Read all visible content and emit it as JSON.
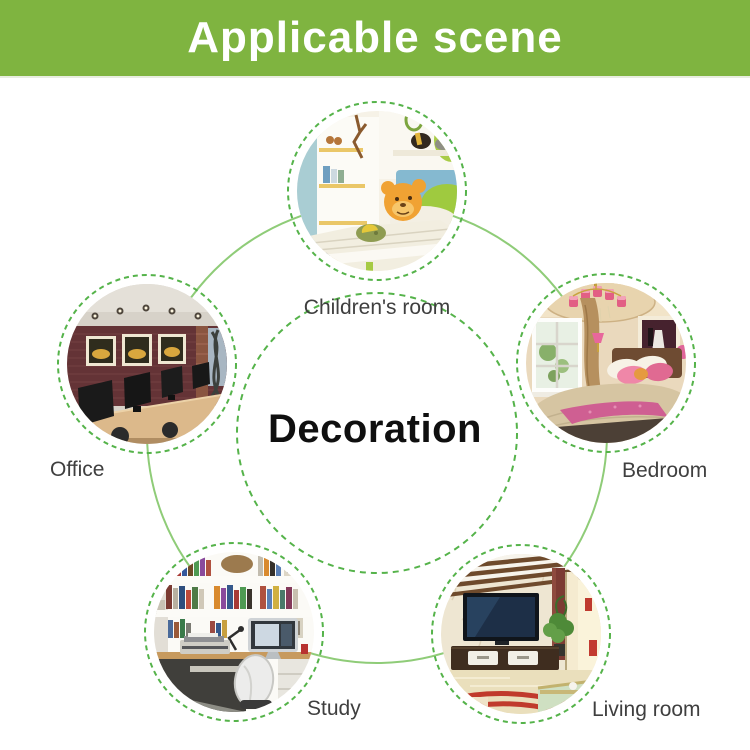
{
  "header": {
    "title": "Applicable scene",
    "bg_color": "#7fb440",
    "text_color": "#ffffff"
  },
  "center": {
    "title": "Decoration"
  },
  "nodes": [
    {
      "id": "children-room",
      "label": "Children's room",
      "scene": "kids bedroom with shelves, bed and orange teddy bear"
    },
    {
      "id": "office",
      "label": "Office",
      "scene": "dark office with brick wall, framed pictures, desk monitors"
    },
    {
      "id": "bedroom",
      "label": "Bedroom",
      "scene": "warm bedroom with chandelier, window, pink bedding"
    },
    {
      "id": "study",
      "label": "Study",
      "scene": "home study with bookshelves, monitor, printer, chair"
    },
    {
      "id": "living-room",
      "label": "Living room",
      "scene": "living room with TV wall, console, plant, rug"
    }
  ],
  "colors": {
    "banner_green": "#7fb440",
    "ring_dashed_green": "#55b34a",
    "ring_solid_green": "#8fcc78",
    "label_text": "#3f3f3f",
    "center_text": "#0f0f0f"
  }
}
